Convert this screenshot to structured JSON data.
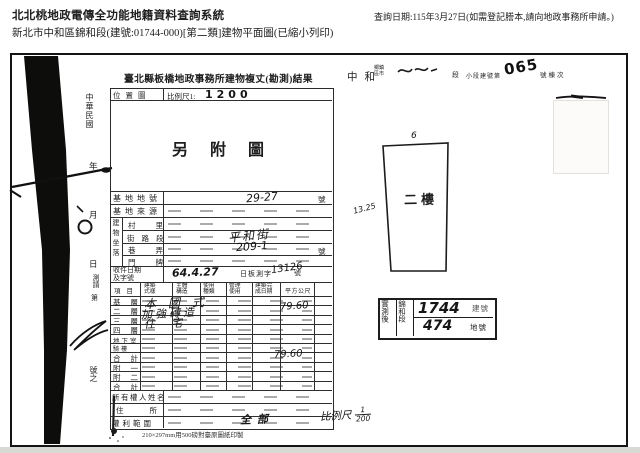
{
  "header": {
    "system_title": "北北桃地政電傳全功能地籍資料查詢系統",
    "subtitle": "新北市中和區錦和段(建號:01744-000)[第二類]建物平面圖(已縮小列印)",
    "query_date": "查詢日期:115年3月27日(如需登記謄本,請向地政事務所申請。)"
  },
  "margin": {
    "era": "中華民國",
    "year": "年",
    "month": "月",
    "day": "日",
    "survey_req": "測請",
    "ordinal": "第",
    "number_of": "號之"
  },
  "form": {
    "title": "臺北縣板橋地政事務所建物複丈(勘測)結果",
    "location_label": "位置圖",
    "scale_prefix": "比例尺1:",
    "scale_value": "1200",
    "map_note": "另附圖",
    "site_lot_label": "基地地號",
    "site_lot_value": "29-27",
    "site_source_label": "基地來源",
    "situs_label": "建物坐落",
    "situs_village_label": "村里",
    "situs_street_label": "街路段",
    "situs_street_value": "平和街",
    "situs_lane_label": "巷弄",
    "situs_lane_value": "209-1",
    "situs_door_label": "門牌",
    "receipt_label": "收件日期及字號",
    "receipt_date": "64.4.27",
    "receipt_prefix": "日板測字",
    "receipt_number": "13126",
    "unit_hao": "號",
    "floor_table": {
      "columns": [
        "項目",
        "建築式樣",
        "主體構造",
        "使用種類",
        "管理使用",
        "建築完成日期",
        "平方公尺"
      ],
      "rows": [
        "基層",
        "二層",
        "三層",
        "四層",
        "地下室",
        "騎樓",
        "合計",
        "附一",
        "附二",
        "合計"
      ],
      "entries": {
        "style": "本國式",
        "structure": "加強磚造",
        "use": "住宅",
        "floor_area": "79.60",
        "total_area": "79.60"
      }
    },
    "owner_label": "所有權人姓名",
    "address_label": "住所",
    "rights_label": "權利範圍",
    "rights_value": "全部",
    "paper_note": "210×297mm用500磅對臺原圖紙印製",
    "plan_scale_label": "比例尺",
    "plan_scale_num": "1",
    "plan_scale_den": "200"
  },
  "top_right": {
    "district": "中和",
    "admin_units": "鄉鎮區市",
    "section_suffix": "段",
    "small_section_label": "小段建號第",
    "building_no": "065",
    "no_suffix": "號棟次"
  },
  "plan": {
    "width_label": "6",
    "height_label": "13.25",
    "floor_label": "二樓"
  },
  "stamp": {
    "left_label": "實測後",
    "section_label": "錦和段",
    "build_no": "1744",
    "build_unit": "建號",
    "lot_no": "474",
    "lot_unit": "地號"
  }
}
